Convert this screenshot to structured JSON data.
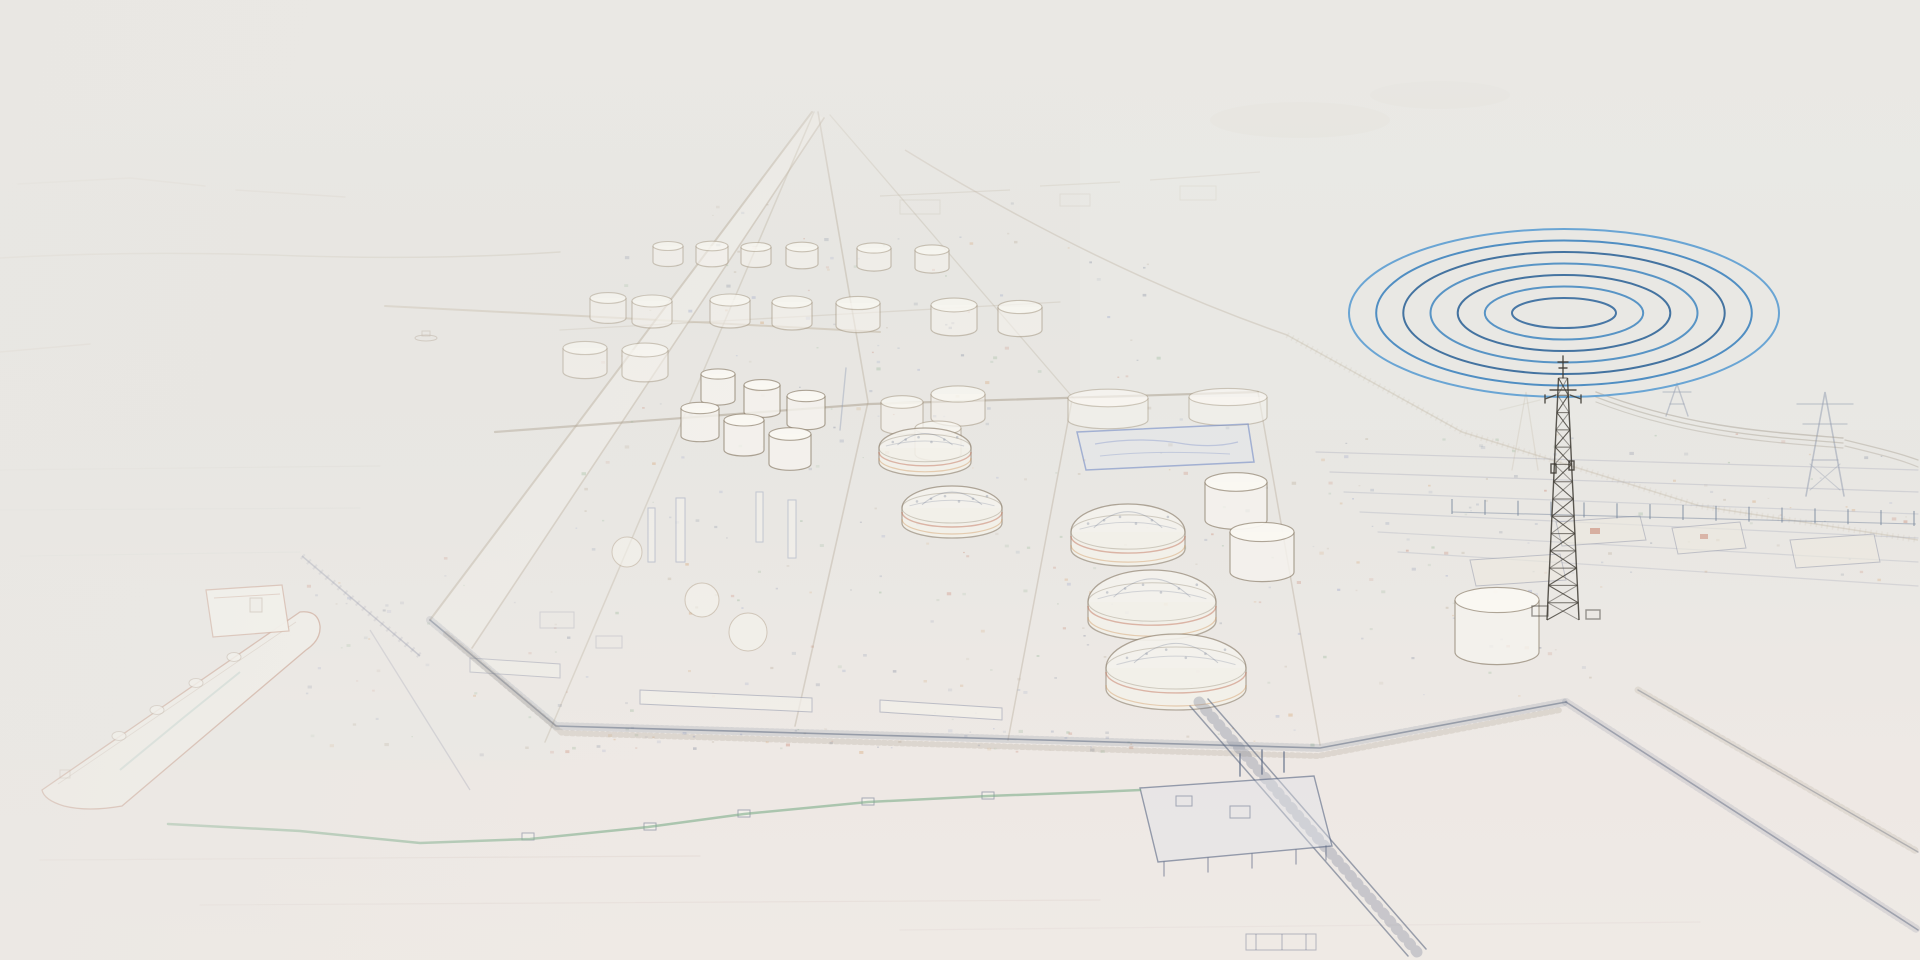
{
  "scene": {
    "subject": "faded aerial pencil-sketch of an LNG terminal and port, with blue radio waves radiating from a communications tower",
    "elements": [
      "sea",
      "breakwater",
      "lng-carrier-ship",
      "loading-jetty",
      "tank-farm",
      "dome-storage-tanks",
      "process-area",
      "quay-edge",
      "pier",
      "floating-boom",
      "laydown-yard",
      "fence-line",
      "power-pylons",
      "transmission-lines",
      "communications-tower",
      "radio-waves"
    ]
  },
  "palette": {
    "background_top": "#e9e8e4",
    "background_mid": "#e7e5e1",
    "background_bottom": "#f0ebe7",
    "paper_white": "#f5f3ed",
    "sketch_tan": "#b3a28c",
    "sketch_slate": "#8f9ab5",
    "sketch_blue": "#7e8fc0",
    "sketch_green": "#86ab88",
    "sketch_rust": "#bf6a52",
    "sketch_orange": "#cf9357",
    "ink_dark": "#45413b"
  },
  "radio_waves": {
    "center_x": 1564,
    "center_y": 313,
    "ring_count": 7,
    "rx_inner": 52,
    "rx_outer": 215,
    "ry_inner": 15,
    "ry_outer": 84,
    "stroke_width": 2,
    "ring_colors": [
      "#3a6d9f",
      "#4b8cc2",
      "#35689a",
      "#4b8cc2",
      "#35689a",
      "#4286bf",
      "#5e9ed2"
    ]
  },
  "comms_tower": {
    "x": 1563,
    "tip_y": 356,
    "top_y": 378,
    "base_y": 620,
    "half_width_top": 4.5,
    "half_width_base": 16,
    "segments": 14,
    "color": "#403c35"
  },
  "fence": {
    "x_start": 1452,
    "x_end": 1916,
    "y": 512,
    "post_spacing": 33,
    "post_height": 13,
    "color": "#6e7f96"
  },
  "tanks": {
    "faint": [
      [
        668,
        262,
        30,
        16
      ],
      [
        712,
        262,
        32,
        16
      ],
      [
        756,
        263,
        30,
        16
      ],
      [
        802,
        264,
        32,
        17
      ],
      [
        874,
        266,
        34,
        18
      ],
      [
        932,
        268,
        34,
        18
      ],
      [
        608,
        318,
        36,
        20
      ],
      [
        652,
        322,
        40,
        21
      ],
      [
        730,
        322,
        40,
        22
      ],
      [
        792,
        324,
        40,
        22
      ],
      [
        858,
        326,
        44,
        23
      ],
      [
        954,
        329,
        46,
        24
      ],
      [
        1020,
        330,
        44,
        23
      ],
      [
        585,
        372,
        44,
        24
      ],
      [
        645,
        375,
        46,
        25
      ],
      [
        902,
        428,
        42,
        26
      ],
      [
        958,
        418,
        54,
        24
      ],
      [
        938,
        454,
        46,
        26
      ]
    ],
    "wide": [
      [
        1108,
        420,
        80,
        22
      ],
      [
        1228,
        417,
        78,
        20
      ]
    ],
    "bright": [
      [
        718,
        400,
        34,
        26
      ],
      [
        762,
        412,
        36,
        27
      ],
      [
        806,
        424,
        38,
        28
      ],
      [
        700,
        436,
        38,
        28
      ],
      [
        744,
        450,
        40,
        30
      ],
      [
        790,
        464,
        42,
        30
      ],
      [
        1236,
        520,
        62,
        38
      ],
      [
        1262,
        572,
        64,
        40
      ],
      [
        1497,
        652,
        84,
        52
      ]
    ]
  },
  "dome_tanks": [
    [
      925,
      448,
      46,
      14,
      20
    ],
    [
      952,
      508,
      50,
      15,
      22
    ],
    [
      1128,
      532,
      57,
      17,
      28
    ],
    [
      1152,
      602,
      64,
      19,
      32
    ],
    [
      1176,
      668,
      70,
      21,
      34
    ]
  ],
  "speckles": {
    "seed": 42,
    "colors": [
      "#8f9ab5",
      "#b3a28c",
      "#7e8fc0",
      "#bf6a52",
      "#86ab88",
      "#cf9357",
      "#6d7890"
    ],
    "zones": [
      {
        "x": 560,
        "y": 402,
        "w": 740,
        "h": 318,
        "n": 170
      },
      {
        "x": 600,
        "y": 200,
        "w": 560,
        "h": 195,
        "n": 80
      },
      {
        "x": 1300,
        "y": 430,
        "w": 612,
        "h": 150,
        "n": 90
      },
      {
        "x": 300,
        "y": 556,
        "w": 260,
        "h": 200,
        "n": 45
      },
      {
        "x": 1310,
        "y": 586,
        "w": 300,
        "h": 110,
        "n": 30
      },
      {
        "x": 560,
        "y": 726,
        "w": 760,
        "h": 26,
        "n": 60
      }
    ]
  }
}
